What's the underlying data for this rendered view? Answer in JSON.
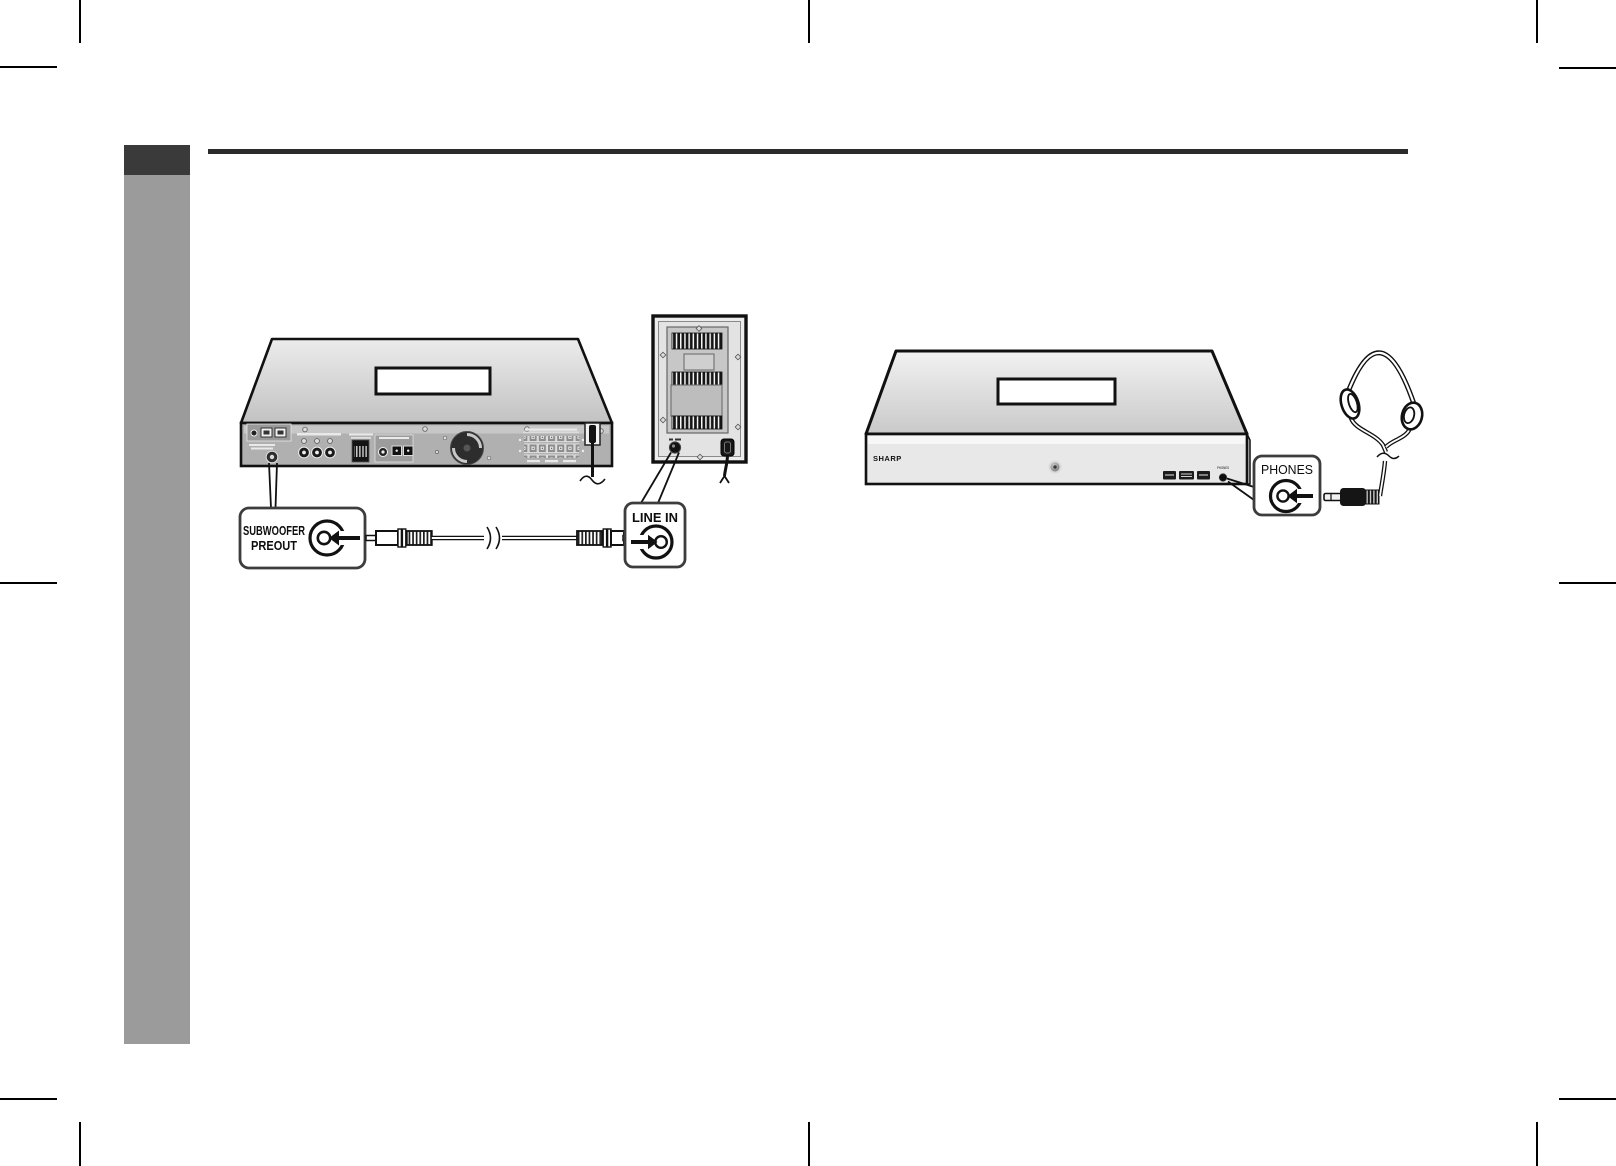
{
  "colors": {
    "sidebar_dark": "#3a3a3a",
    "sidebar_gray": "#9b9b9b",
    "section_rule": "#2b2b2b",
    "line_art": "#111111"
  },
  "left_diagram": {
    "subwoofer_callout_line1": "SUBWOOFER",
    "subwoofer_callout_line2": "PREOUT",
    "line_in_label": "LINE IN"
  },
  "right_diagram": {
    "brand_logo": "SHARP",
    "phones_panel_label": "PHONES",
    "phones_callout_label": "PHONES"
  }
}
